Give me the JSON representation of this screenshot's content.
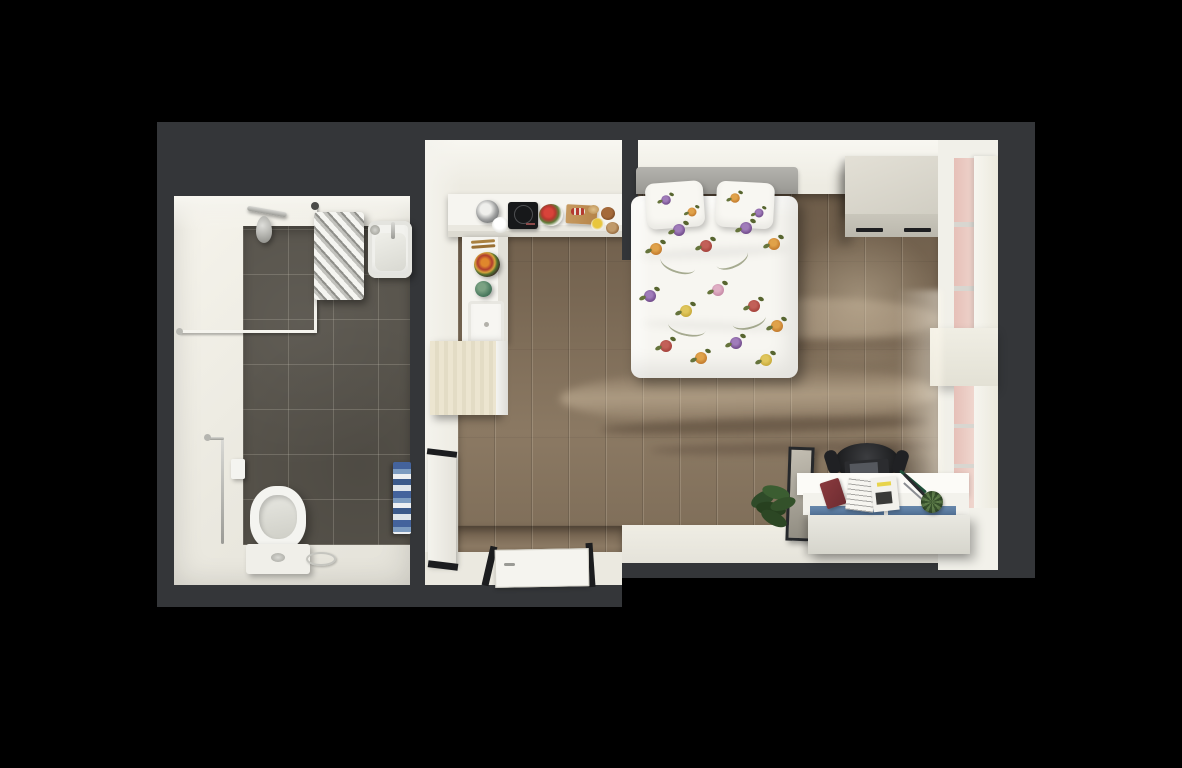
{
  "scene": {
    "kind": "3d-top-down-floor-plan-render",
    "apartment_type": "studio with separate bathroom",
    "background_color": "#000000",
    "structural_wall_color": "#343639",
    "interior_wall_color": "#edebe2"
  },
  "bathroom": {
    "name": "bathroom",
    "floor_tile_color": "#57534b",
    "wall_color": "#ebe9e0",
    "fixtures": [
      {
        "name": "shower-head",
        "color": "#b9b9b4"
      },
      {
        "name": "shower-curtain-rail",
        "color": "#f5f4ee"
      },
      {
        "name": "towel-radiator",
        "color": "#e9e9e4"
      },
      {
        "name": "wash-basin",
        "color": "#f2f2ee"
      },
      {
        "name": "toilet",
        "color": "#f4f4f0"
      },
      {
        "name": "towel-rail",
        "color": "#c2c2bd"
      },
      {
        "name": "toilet-paper-holder",
        "color": "#f4f4f0"
      },
      {
        "name": "striped-towel",
        "colors": [
          "#44639c",
          "#7d9cc0",
          "#eef0f2"
        ]
      },
      {
        "name": "floor-drain",
        "color": "#c5c5bf"
      }
    ]
  },
  "studio_room": {
    "name": "studio-room",
    "floor_color": "#7c6b57",
    "floor_material": "wood planks",
    "furniture": [
      {
        "name": "kitchen-counter",
        "shape": "L",
        "color": "#f6f5f0",
        "items": [
          "cooking-pot",
          "white-bowl",
          "induction-hob",
          "tomato-plate",
          "cutting-board",
          "bread",
          "brown-bowl",
          "yellow-bowl",
          "wooden-bowl",
          "wooden-utensils",
          "salad-plate",
          "decor-ball",
          "kitchen-sink"
        ]
      },
      {
        "name": "fridge",
        "color": "#e8e1cc"
      },
      {
        "name": "double-bed",
        "duvet_color": "#f7f6f1",
        "pattern": "floral-pansies",
        "pattern_colors": [
          "#6d4787",
          "#c0772a",
          "#a34039",
          "#c5a737"
        ],
        "headboard_color": "#a3a29d",
        "pillows": 2
      },
      {
        "name": "wardrobe",
        "color": "#d5d2c7",
        "handles": 2,
        "handle_color": "#1e1f21"
      },
      {
        "name": "desk",
        "color": "#efeee8",
        "drawer_accent_color": "#5e7ea4",
        "items": [
          "red-book",
          "magazines",
          "pens",
          "succulent",
          "laptop"
        ]
      },
      {
        "name": "office-chair",
        "color": "#232427"
      },
      {
        "name": "mirror",
        "frame_color": "#26282b"
      },
      {
        "name": "potted-plant",
        "leaf_color": "#2f4b29"
      },
      {
        "name": "closet",
        "color": "#f0efe9",
        "trim_color": "#1c1d1f"
      },
      {
        "name": "entry-door",
        "color": "#f5f4ef"
      }
    ],
    "window_wall": {
      "position": "right",
      "glazing_tint": "#e4beb6",
      "mullion_color": "#d8d6d0",
      "curtain_color": "#f5f4ee"
    }
  }
}
